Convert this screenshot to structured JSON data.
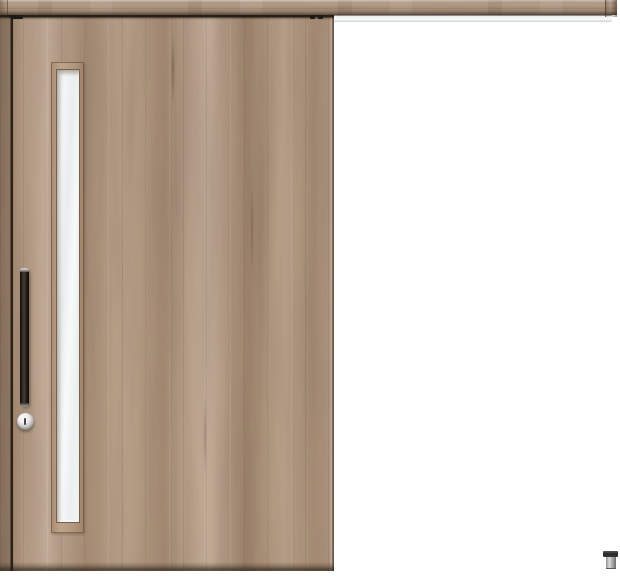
{
  "meta": {
    "subject": "Product image of a wooden outset sliding interior door with a narrow vertical glass slit, long black bar handle, round thumb-turn lock, full-width top hanging rail and a small floor guide at lower right",
    "canvas": {
      "width": 620,
      "height": 576
    },
    "text_content": "none — image contains no visible text"
  },
  "components": [
    {
      "name": "top-rail",
      "description": "wood fascia rail spanning full width with end caps"
    },
    {
      "name": "hanging-track",
      "description": "white/silver track strip under the rail, exposed to the right of the door"
    },
    {
      "name": "sliding-door",
      "description": "light greige woodgrain door panel, closed position at left"
    },
    {
      "name": "glass-panel",
      "description": "tall narrow frosted glass slit near the left stile"
    },
    {
      "name": "door-handle",
      "description": "vertical black bar pull handle"
    },
    {
      "name": "thumb-turn-lock",
      "description": "round metallic thumb-turn below the handle"
    },
    {
      "name": "door-hangers",
      "description": "dark roller hardware visible in the gap at the door top corners"
    },
    {
      "name": "floor-guide",
      "description": "small metal guide block on the floor at lower right"
    }
  ],
  "palette": {
    "background": "#ffffff",
    "wood-base": "#b69c85",
    "wood-light": "#c9b29c",
    "wood-dark": "#9a8069",
    "rail-wood": "#b89e86",
    "track-white": "#f7f8f8",
    "track-line": "#878d8e",
    "glass-light": "#f5f7f7",
    "glass-shade": "#e2e6e7",
    "frame-edge": "#77614c",
    "handle-dark": "#221b16",
    "handle-cap": "#b5b2ae",
    "lock-metal": "#d9d8d6",
    "guide-cap": "#262626",
    "guide-body": "#b5b5b5"
  }
}
